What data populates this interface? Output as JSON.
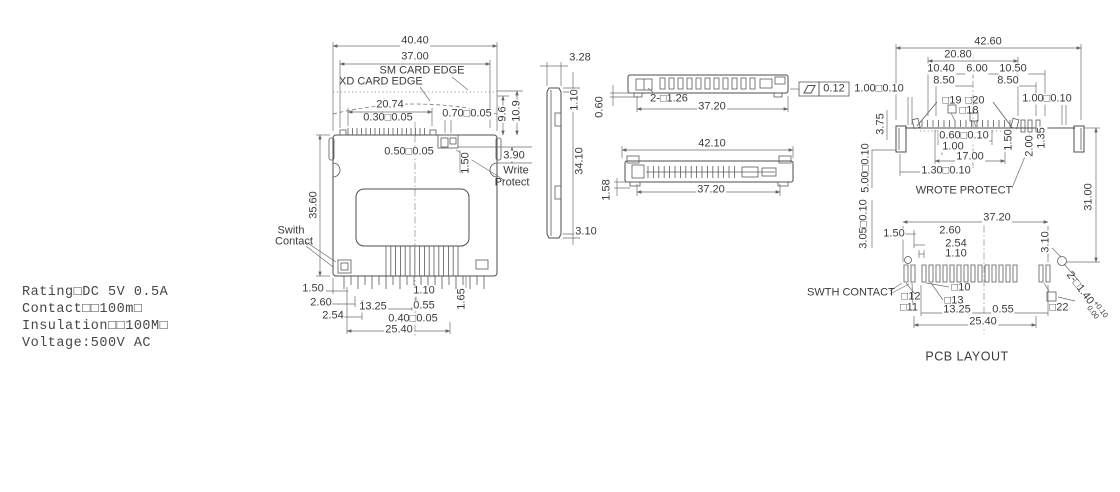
{
  "spec_block": {
    "lines": {
      "rating": "Rating□DC 5V 0.5A",
      "contact": "Contact□□100m□",
      "insulation": "Insulation□□100M□",
      "voltage": "Voltage:500V AC"
    }
  },
  "front_view": {
    "overall_width": "40.40",
    "body_width": "37.00",
    "sm_card_edge_label": "SM CARD EDGE",
    "xd_card_edge_label": "XD CARD EDGE",
    "pin_span": "20.74",
    "pin_pitch_tol": "0.30□0.05",
    "wp_slot_tol": "0.70□0.05",
    "edge_height_sm": "9.6",
    "edge_height_xd": "10.9",
    "pin_width_tol": "0.50□0.05",
    "wp_depth": "1.50",
    "wp_height": "3.90",
    "write_protect_line1": "Write",
    "write_protect_line2": "Protect",
    "body_height": "35.60",
    "switch_label_line1": "Swith",
    "switch_label_line2": "Contact",
    "bottom_offset": "1.50",
    "bottom_2_60": "2.60",
    "bottom_pitch": "2.54",
    "bottom_13_25": "13.25",
    "bottom_1_10": "1.10",
    "bottom_0_55": "0.55",
    "bottom_pin_tol": "0.40□0.05",
    "bottom_span": "25.40",
    "pin_length": "1.65"
  },
  "side_view": {
    "top_width": "3.28",
    "top_step": "1.10",
    "height": "34.10",
    "bottom_step": "3.10"
  },
  "top_view_a": {
    "foot_height": "0.60",
    "hole_note": "2-□1.26",
    "span": "37.20",
    "flatness_tol": "0.12"
  },
  "top_view_b": {
    "overall": "42.10",
    "span": "37.20",
    "foot": "1.58"
  },
  "pcb_layout": {
    "caption": "PCB LAYOUT",
    "overall": "42.60",
    "d20_80": "20.80",
    "d10_40": "10.40",
    "d6_00": "6.00",
    "d10_50": "10.50",
    "d8_50_left": "8.50",
    "d8_50_right": "8.50",
    "d1_00_tol_left": "1.00□0.10",
    "d1_00_tol_right": "1.00□0.10",
    "pad19": "□19",
    "pad20": "□20",
    "pad18": "□18",
    "d3_75": "3.75",
    "d0_60_tol": "0.60□0.10",
    "d1_00": "1.00",
    "d17_00": "17.00",
    "d1_50_mid": "1.50",
    "d2_00": "2.00",
    "d1_35": "1.35",
    "d1_30_tol": "1.30□0.10",
    "wrote_protect_label": "WROTE PROTECT",
    "d5_00_tol": "5.00□0.10",
    "d3_05_tol": "3.05□0.10",
    "d31_00": "31.00",
    "d37_20": "37.20",
    "d2_60": "2.60",
    "d2_54": "2.54",
    "d1_10": "1.10",
    "d1_50_left": "1.50",
    "d3_10": "3.10",
    "swth_contact_label": "SWTH CONTACT",
    "pad12": "□12",
    "pad11": "□11",
    "pad10": "□10",
    "pad13": "□13",
    "pad22": "□22",
    "d13_25": "13.25",
    "d0_55": "0.55",
    "d25_40": "25.40",
    "hole_note": "2-□1.40",
    "hole_tol_plus": "+0.10",
    "hole_tol_minus": "0.00"
  }
}
